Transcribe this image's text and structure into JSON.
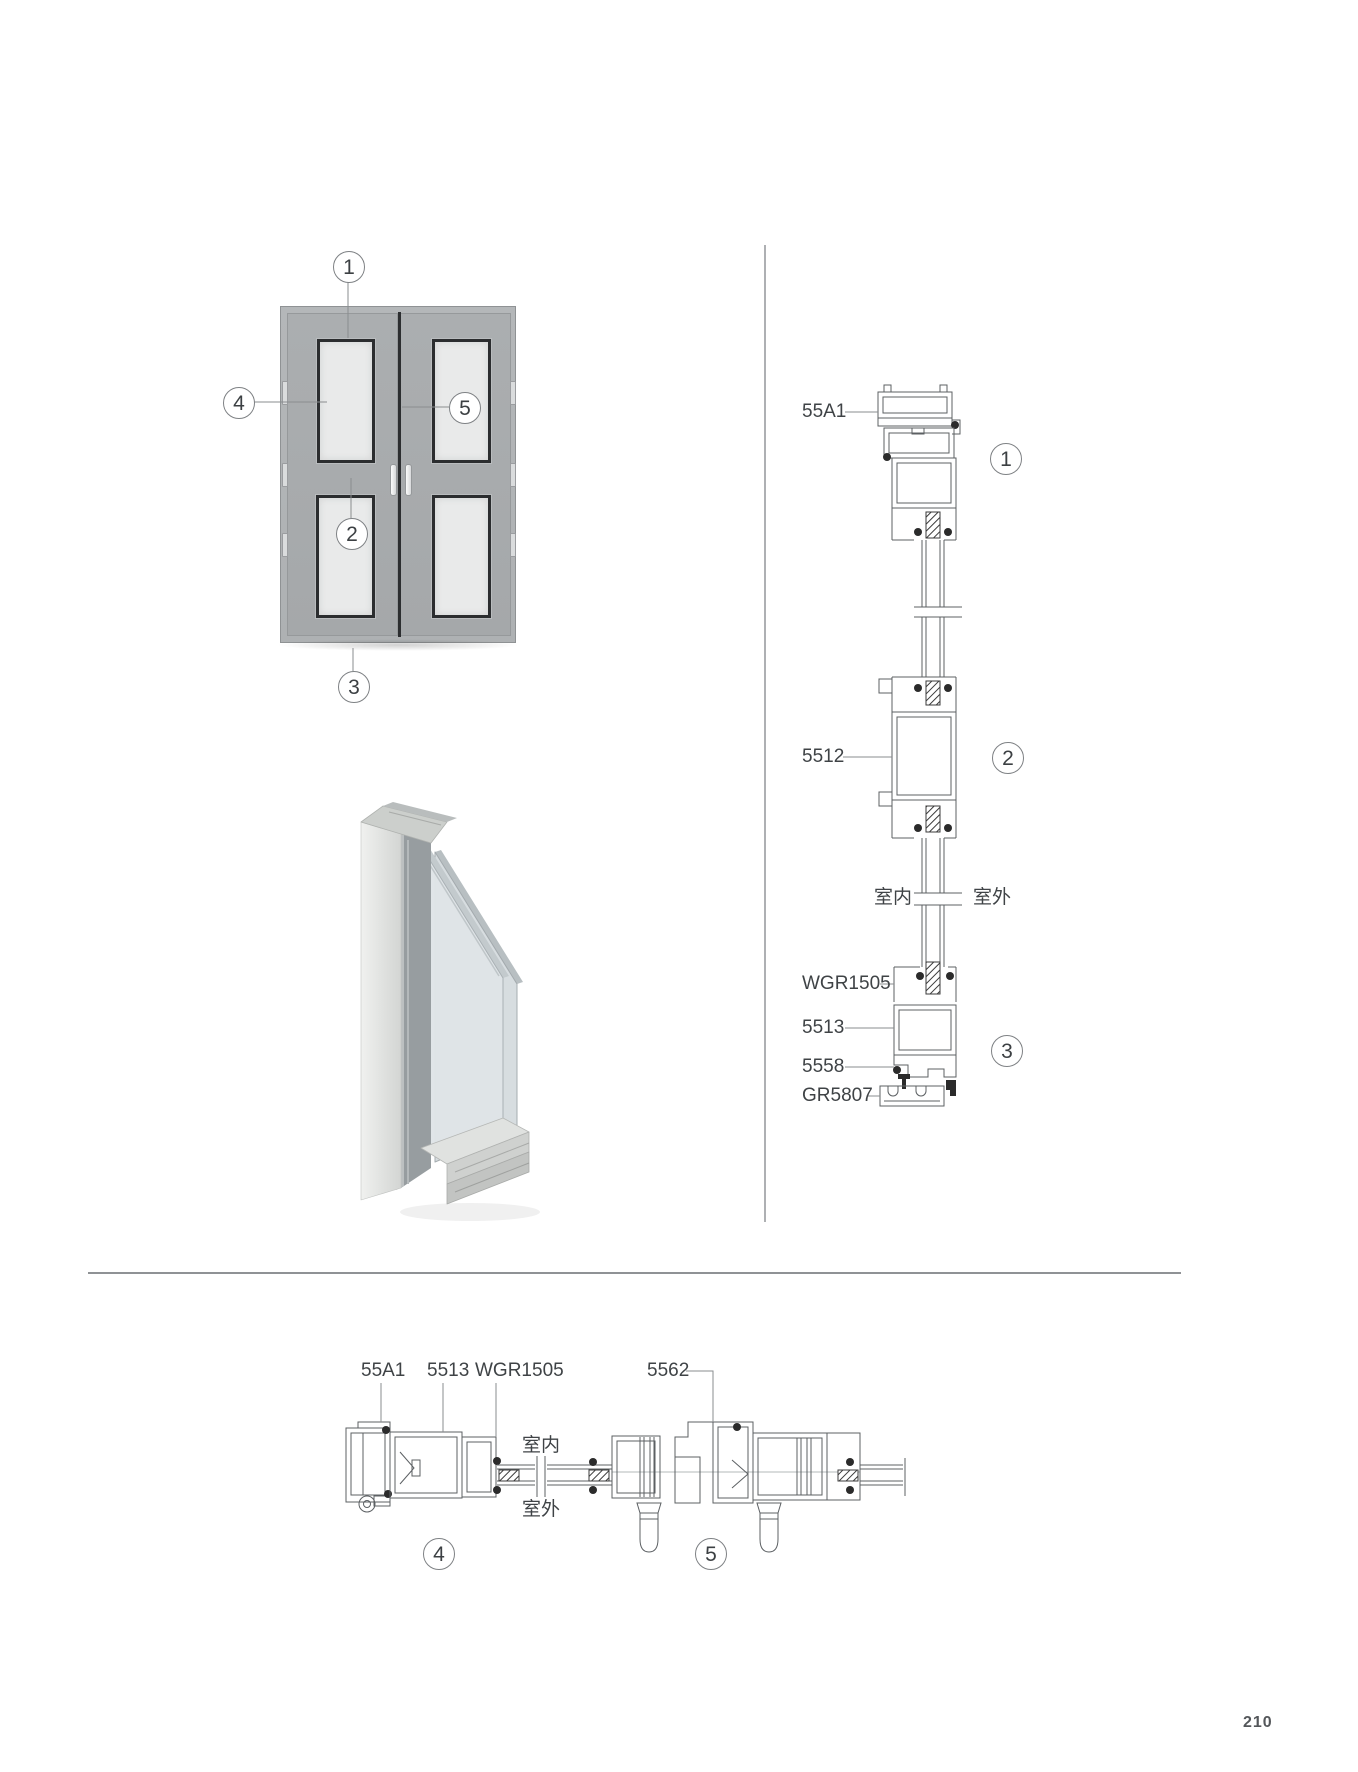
{
  "page": {
    "number": "210"
  },
  "front_view": {
    "callouts": [
      {
        "n": "1"
      },
      {
        "n": "2"
      },
      {
        "n": "3"
      },
      {
        "n": "4"
      },
      {
        "n": "5"
      }
    ]
  },
  "vertical_section": {
    "labels": [
      {
        "text": "55A1"
      },
      {
        "text": "5512"
      },
      {
        "text": "WGR1505"
      },
      {
        "text": "5513"
      },
      {
        "text": "5558"
      },
      {
        "text": "GR5807"
      }
    ],
    "indoor_label": "室内",
    "outdoor_label": "室外",
    "callouts": [
      {
        "n": "1"
      },
      {
        "n": "2"
      },
      {
        "n": "3"
      }
    ]
  },
  "horizontal_section": {
    "labels": [
      {
        "text": "55A1"
      },
      {
        "text": "5513"
      },
      {
        "text": "WGR1505"
      },
      {
        "text": "5562"
      }
    ],
    "indoor_label": "室内",
    "outdoor_label": "室外",
    "callouts": [
      {
        "n": "4"
      },
      {
        "n": "5"
      }
    ]
  },
  "colors": {
    "door_frame": "#b1b4b6",
    "door_leaf": "#a8abad",
    "glass_panel": "#e9eaea",
    "glass_border": "#2b2d2f",
    "drawing_line": "#5c6063",
    "divider_line": "#8f9295",
    "label_text": "#3f4346"
  }
}
